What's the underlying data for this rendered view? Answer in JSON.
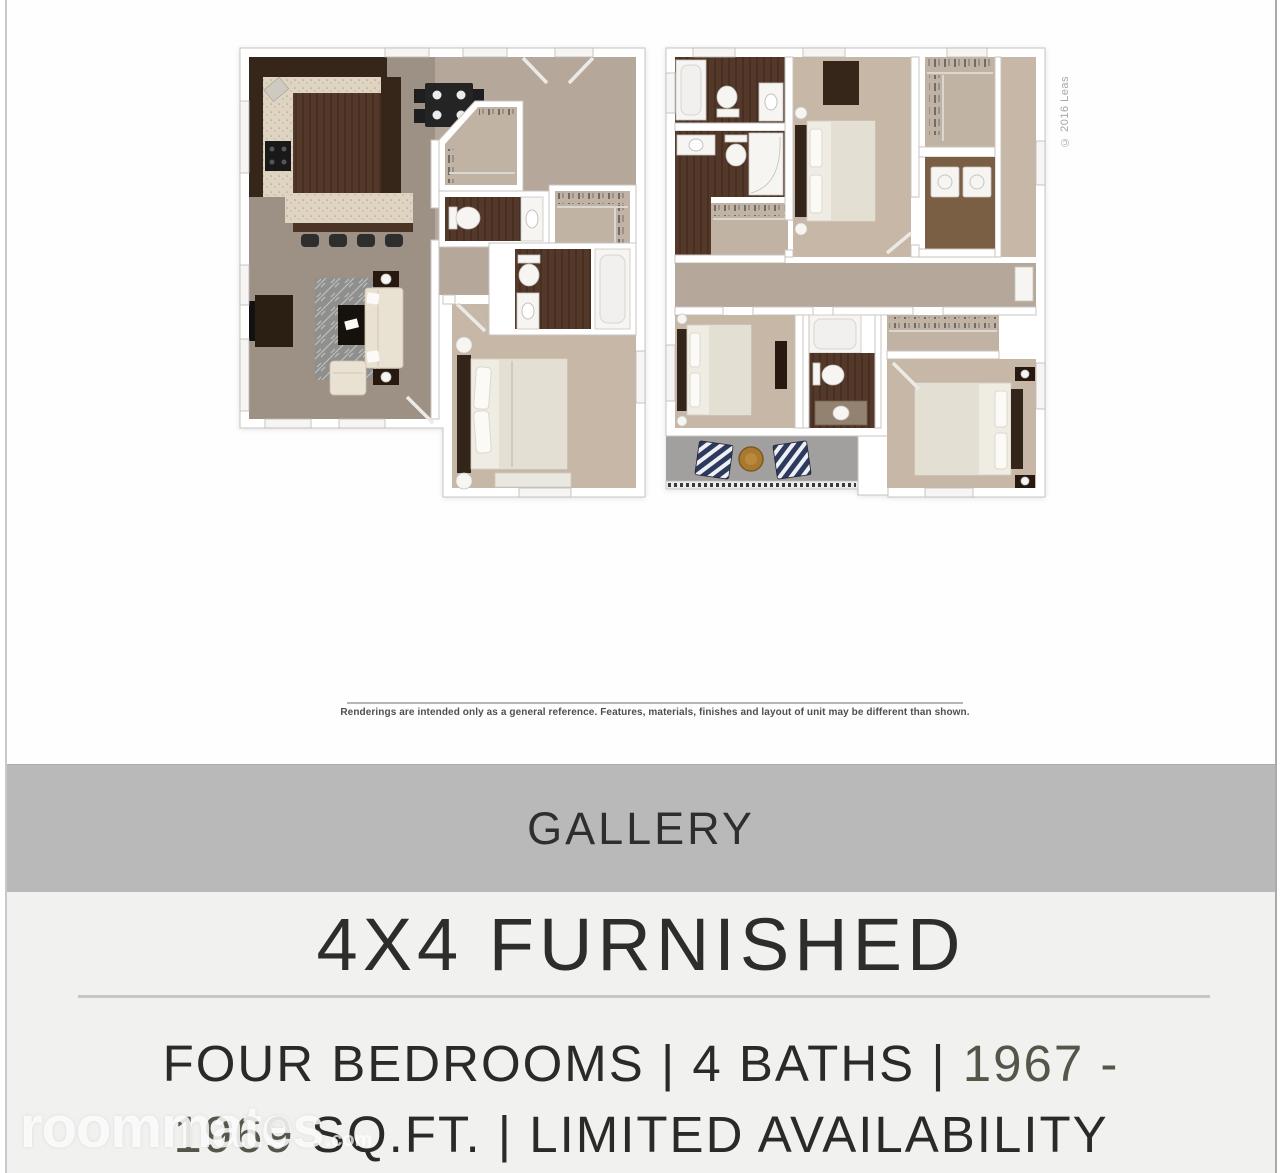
{
  "floorplan_section": {
    "copyright_text": "© 2016 Leas",
    "disclaimer": "Renderings are intended only as a general reference. Features, materials, finishes and layout of unit may be different than shown.",
    "plan_count": "2"
  },
  "gallery_bar": {
    "label": "GALLERY"
  },
  "unit_info": {
    "title": "4X4 FURNISHED",
    "details_line1_main": "FOUR BEDROOMS | 4 BATHS | ",
    "details_line1_accent": "1967 -",
    "details_line2_accent": "1969",
    "details_line2_main": " SQ.FT. | LIMITED AVAILABILITY"
  },
  "watermark": {
    "brand": "roommates",
    "tld": ".com"
  },
  "colors": {
    "gallery_band": "#b9b9b9",
    "details_background": "#f1f1ef",
    "heading_text": "#2d2d2b",
    "accent_numbers": "#56554a",
    "divider": "#c7c7c7"
  }
}
